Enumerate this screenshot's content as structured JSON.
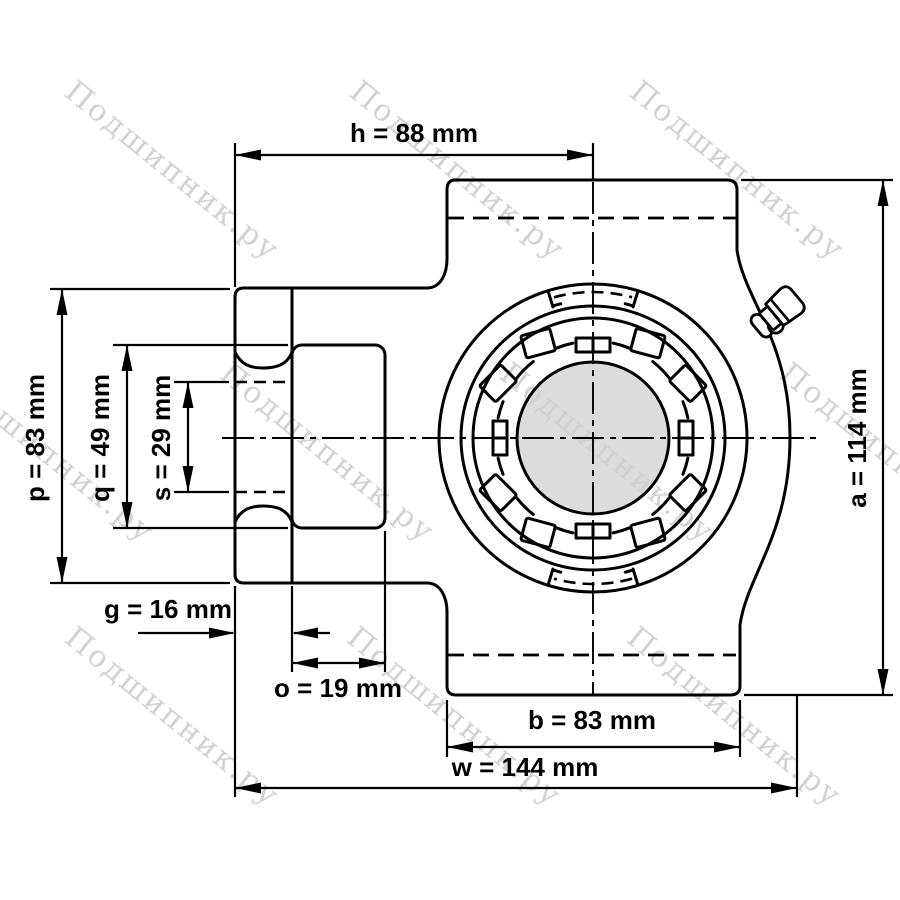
{
  "watermark": {
    "text": "Подшипник.ру",
    "color": "#d2d2d2"
  },
  "dimensions": {
    "h": {
      "label": "h = 88 mm"
    },
    "a": {
      "label": "a = 114 mm"
    },
    "p": {
      "label": "p = 83 mm"
    },
    "q": {
      "label": "q = 49 mm"
    },
    "s": {
      "label": "s = 29 mm"
    },
    "g": {
      "label": "g = 16 mm"
    },
    "o": {
      "label": "o = 19 mm"
    },
    "b": {
      "label": "b = 83 mm"
    },
    "w": {
      "label": "w = 144 mm"
    }
  },
  "colors": {
    "background": "#ffffff",
    "line": "#000000",
    "shaft_fill": "#dcdcdc",
    "watermark": "#d2d2d2"
  }
}
